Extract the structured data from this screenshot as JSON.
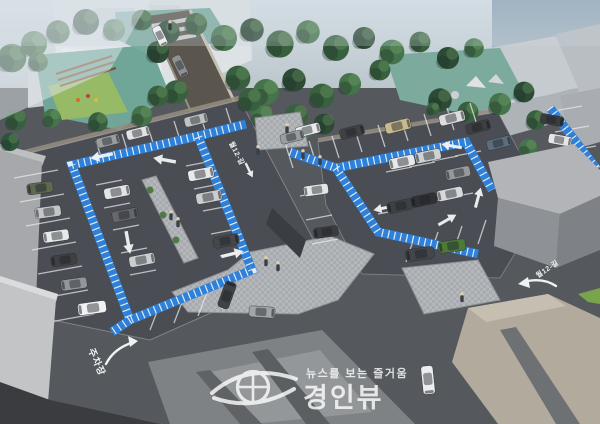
{
  "labels": {
    "north_road": "월12-길",
    "east_road": "월12-길",
    "entrance": "주차장"
  },
  "watermark": {
    "tagline": "뉴스를 보는 즐거움",
    "brand": "경인뷰"
  },
  "colors": {
    "walkway_blue": "#2e80d8",
    "asphalt": "#55585d",
    "lot_asphalt": "#4a4e54",
    "paving_light": "#b5b8bb",
    "teal_ground": "#7cab9e",
    "tree_green": "#38603f"
  },
  "scene": {
    "trees": [
      [
        12,
        58,
        1.1,
        "#38603f"
      ],
      [
        34,
        44,
        1.0,
        "#45734b"
      ],
      [
        58,
        32,
        0.9,
        "#38603f"
      ],
      [
        86,
        22,
        1.0,
        "#2c4a35"
      ],
      [
        114,
        30,
        0.85,
        "#45734b"
      ],
      [
        142,
        20,
        0.8,
        "#38603f"
      ],
      [
        168,
        32,
        0.9,
        "#2c4a35"
      ],
      [
        196,
        24,
        0.85,
        "#38603f"
      ],
      [
        224,
        38,
        1.0,
        "#45734b"
      ],
      [
        252,
        30,
        0.9,
        "#2c4a35"
      ],
      [
        280,
        44,
        1.05,
        "#38603f"
      ],
      [
        308,
        32,
        0.9,
        "#45734b"
      ],
      [
        336,
        48,
        1.0,
        "#38603f"
      ],
      [
        364,
        38,
        0.85,
        "#2c4a35"
      ],
      [
        392,
        52,
        0.95,
        "#45734b"
      ],
      [
        420,
        42,
        0.8,
        "#38603f"
      ],
      [
        448,
        58,
        0.85,
        "#2c4a35"
      ],
      [
        474,
        48,
        0.75,
        "#45734b"
      ],
      [
        38,
        62,
        0.75,
        "#38603f"
      ],
      [
        158,
        52,
        0.85,
        "#2c4a35"
      ],
      [
        176,
        92,
        0.9,
        "#38603f"
      ],
      [
        142,
        116,
        0.8,
        "#45734b"
      ],
      [
        98,
        122,
        0.75,
        "#38603f"
      ],
      [
        52,
        118,
        0.7,
        "#45734b"
      ],
      [
        16,
        120,
        0.8,
        "#38603f"
      ],
      [
        10,
        142,
        0.7,
        "#2f543c"
      ],
      [
        238,
        78,
        0.95,
        "#38603f"
      ],
      [
        266,
        92,
        1.0,
        "#45734b"
      ],
      [
        294,
        80,
        0.9,
        "#2c4a35"
      ],
      [
        322,
        96,
        0.95,
        "#38603f"
      ],
      [
        350,
        84,
        0.85,
        "#45734b"
      ],
      [
        296,
        116,
        0.9,
        "#38603f"
      ],
      [
        324,
        124,
        0.8,
        "#2c4a35"
      ],
      [
        262,
        116,
        0.85,
        "#45734b"
      ],
      [
        250,
        100,
        0.9,
        "#38603f"
      ],
      [
        158,
        96,
        0.8,
        "#38603f"
      ],
      [
        380,
        70,
        0.8,
        "#38603f"
      ],
      [
        440,
        100,
        0.9,
        "#2c4a35"
      ],
      [
        468,
        112,
        0.8,
        "#38603f"
      ],
      [
        500,
        104,
        0.85,
        "#45734b"
      ],
      [
        524,
        92,
        0.8,
        "#2c4a35"
      ],
      [
        536,
        120,
        0.75,
        "#38603f"
      ],
      [
        528,
        148,
        0.7,
        "#45734b"
      ],
      [
        305,
        132,
        0.55,
        "#45734b"
      ],
      [
        433,
        109,
        0.5,
        "#38603f"
      ]
    ],
    "cars": [
      [
        160,
        36,
        64,
        0.8,
        "#ecedee"
      ],
      [
        180,
        66,
        64,
        0.85,
        "#8e9093"
      ],
      [
        108,
        141,
        -14,
        0.9,
        "#9a9c9e"
      ],
      [
        138,
        133,
        -14,
        0.9,
        "#e2e3e4"
      ],
      [
        196,
        120,
        -14,
        0.9,
        "#c0c2c4"
      ],
      [
        40,
        188,
        172,
        1,
        "#5d6950"
      ],
      [
        48,
        212,
        172,
        1,
        "#c4c6c8"
      ],
      [
        56,
        236,
        172,
        1,
        "#e8e9ea"
      ],
      [
        64,
        260,
        172,
        1,
        "#3e4043"
      ],
      [
        74,
        284,
        172,
        1,
        "#94969a"
      ],
      [
        92,
        308,
        172,
        1.1,
        "#f0f1f2"
      ],
      [
        117,
        192,
        -11,
        1,
        "#e3e4e5"
      ],
      [
        125,
        215,
        -11,
        1,
        "#65676a"
      ],
      [
        142,
        260,
        -11,
        1,
        "#cbcdcf"
      ],
      [
        201,
        174,
        -11,
        1,
        "#e8e9ea"
      ],
      [
        209,
        197,
        -11,
        1,
        "#caccce"
      ],
      [
        226,
        241,
        -11,
        1,
        "#45474a"
      ],
      [
        227,
        295,
        -70,
        1.05,
        "#3f4246"
      ],
      [
        262,
        312,
        4,
        1,
        "#a3a5a8"
      ],
      [
        308,
        130,
        -14,
        0.95,
        "#e8e9ea"
      ],
      [
        292,
        137,
        -14,
        0.9,
        "#9a9c9e"
      ],
      [
        352,
        132,
        -14,
        0.95,
        "#3f4144"
      ],
      [
        398,
        126,
        -14,
        1,
        "#c9b98f"
      ],
      [
        452,
        118,
        -14,
        1,
        "#dcdddf"
      ],
      [
        478,
        127,
        -14,
        0.95,
        "#3c3e41"
      ],
      [
        499,
        143,
        -14,
        0.95,
        "#5c6e7e"
      ],
      [
        402,
        162,
        168,
        1,
        "#e7e8e9"
      ],
      [
        428,
        156,
        168,
        1,
        "#cfd1d3"
      ],
      [
        458,
        173,
        168,
        0.95,
        "#97999c"
      ],
      [
        400,
        206,
        168,
        1,
        "#3e4043"
      ],
      [
        424,
        200,
        168,
        1,
        "#2f3134"
      ],
      [
        450,
        194,
        168,
        1,
        "#d8d9da"
      ],
      [
        316,
        190,
        172,
        0.95,
        "#e4e5e6"
      ],
      [
        326,
        232,
        172,
        0.95,
        "#3a3c3f"
      ],
      [
        452,
        246,
        172,
        1.05,
        "#4e7a39"
      ],
      [
        420,
        254,
        172,
        1.1,
        "#43464a"
      ],
      [
        552,
        120,
        10,
        0.9,
        "#3a3c3f"
      ],
      [
        560,
        140,
        10,
        0.9,
        "#e5e6e7"
      ],
      [
        568,
        160,
        10,
        0.9,
        "#56585b"
      ],
      [
        428,
        380,
        84,
        1.1,
        "#ecedee"
      ]
    ],
    "arrows": [
      [
        102,
        156,
        168,
        1
      ],
      [
        165,
        160,
        190,
        1
      ],
      [
        128,
        242,
        80,
        1
      ],
      [
        232,
        254,
        -14,
        1
      ],
      [
        384,
        208,
        168,
        0.9
      ],
      [
        452,
        146,
        190,
        0.9
      ],
      [
        478,
        198,
        -75,
        0.9
      ],
      [
        447,
        220,
        -30,
        0.9
      ],
      [
        249,
        170,
        64,
        0.7
      ]
    ],
    "people": [
      [
        266,
        262
      ],
      [
        278,
        267
      ],
      [
        258,
        151
      ],
      [
        303,
        155
      ],
      [
        320,
        161
      ],
      [
        171,
        216
      ],
      [
        178,
        223
      ],
      [
        462,
        298
      ],
      [
        287,
        129
      ],
      [
        170,
        26
      ]
    ]
  }
}
